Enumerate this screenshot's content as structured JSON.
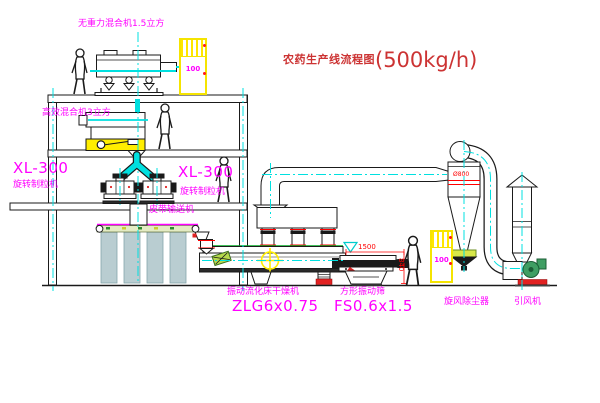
{
  "diagram": {
    "title": {
      "name_cn": "农药生产线流程图",
      "capacity": "(500kg/h)"
    },
    "equipment_labels": {
      "gravity_mixer": "无重力混合机1.5立方",
      "high_eff_mixer": "高效混合机3立方",
      "granulator_left_model": "XL-300",
      "granulator_left_name": "旋转制粒机",
      "granulator_right_model": "XL-300",
      "granulator_right_name": "旋转制粒机",
      "belt_conveyor": "皮带输送机",
      "dryer_name": "振动流化床干燥机",
      "dryer_model": "ZLG6x0.75",
      "sieve_name": "方形振动筛",
      "sieve_model": "FS0.6x1.5",
      "cyclone": "旋风除尘器",
      "fan": "引风机"
    },
    "dimensions": {
      "sieve_length": "1500",
      "sieve_height": "840",
      "cyclone_diameter": "Ø800"
    },
    "control_cabinets": [
      {
        "label": "100"
      },
      {
        "label": "100"
      }
    ],
    "colors": {
      "line": "#1a1a1a",
      "centerline": "#00e0e0",
      "label": "#ff00ff",
      "title": "#cc3333",
      "dimension": "#ff0000",
      "highlight_yellow": "#ffee00",
      "machine_green": "#3f9e63",
      "base_red": "#e22222"
    }
  }
}
